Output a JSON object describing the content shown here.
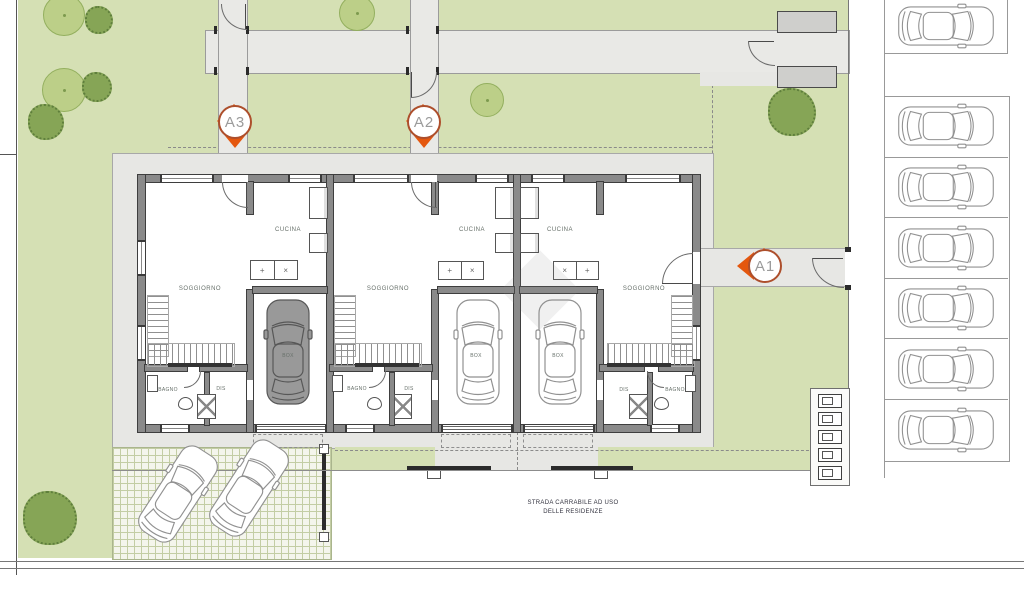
{
  "site": {
    "road_label_1": "STRADA CARRABILE AD USO",
    "road_label_2": "DELLE RESIDENZE"
  },
  "units": [
    {
      "id": "A3",
      "rooms": {
        "soggiorno": "SOGGIORNO",
        "cucina": "CUCINA",
        "box": "BOX",
        "bagno": "BAGNO",
        "dis": "DIS"
      }
    },
    {
      "id": "A2",
      "rooms": {
        "soggiorno": "SOGGIORNO",
        "cucina": "CUCINA",
        "box": "BOX",
        "bagno": "BAGNO",
        "dis": "DIS"
      }
    },
    {
      "id": "A1",
      "rooms": {
        "soggiorno": "SOGGIORNO",
        "cucina": "CUCINA",
        "box": "BOX",
        "bagno": "BAGNO",
        "dis": "DIS"
      }
    }
  ],
  "parking": {
    "street_spaces_with_cars": 7,
    "visitor_cars": 2,
    "garage_cars": 3
  },
  "colors": {
    "lawn": "#d5e0b4",
    "pavement": "#e9e9e6",
    "accent_orange": "#e4570e",
    "marker_ring": "#ad4f2c",
    "tree": "#bccf88",
    "bush": "#86a556"
  }
}
